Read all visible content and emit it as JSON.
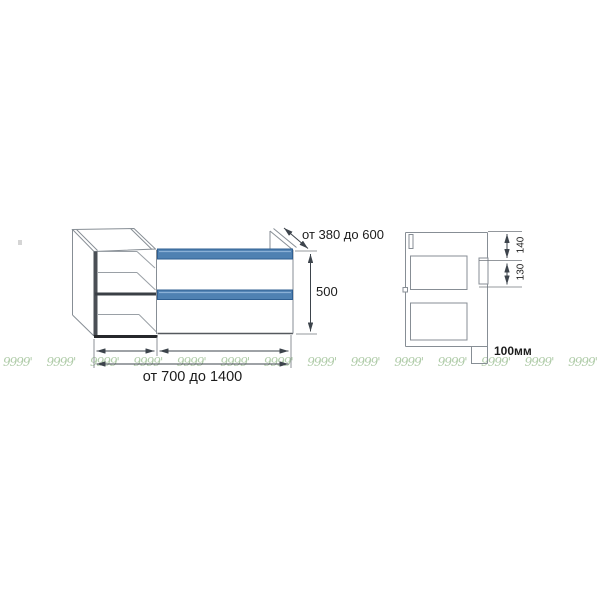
{
  "dimensions": {
    "depth_label": "от 380 до 600",
    "height_label": "500",
    "width_label": "от 700 до 1400",
    "side_top_label": "140",
    "side_middle_label": "130",
    "plinth_label": "100мм"
  },
  "colors": {
    "accent_blue": "#4f81b2",
    "accent_blue_dark": "#2f5f92",
    "accent_blue_light": "#8ab0d6",
    "line_gray": "#878e95",
    "dim_line": "#3d444c",
    "text_color": "#1c1c1c",
    "watermark_green": "#a8c7a0"
  },
  "watermark": {
    "glyph": "9999'",
    "count": 14
  }
}
